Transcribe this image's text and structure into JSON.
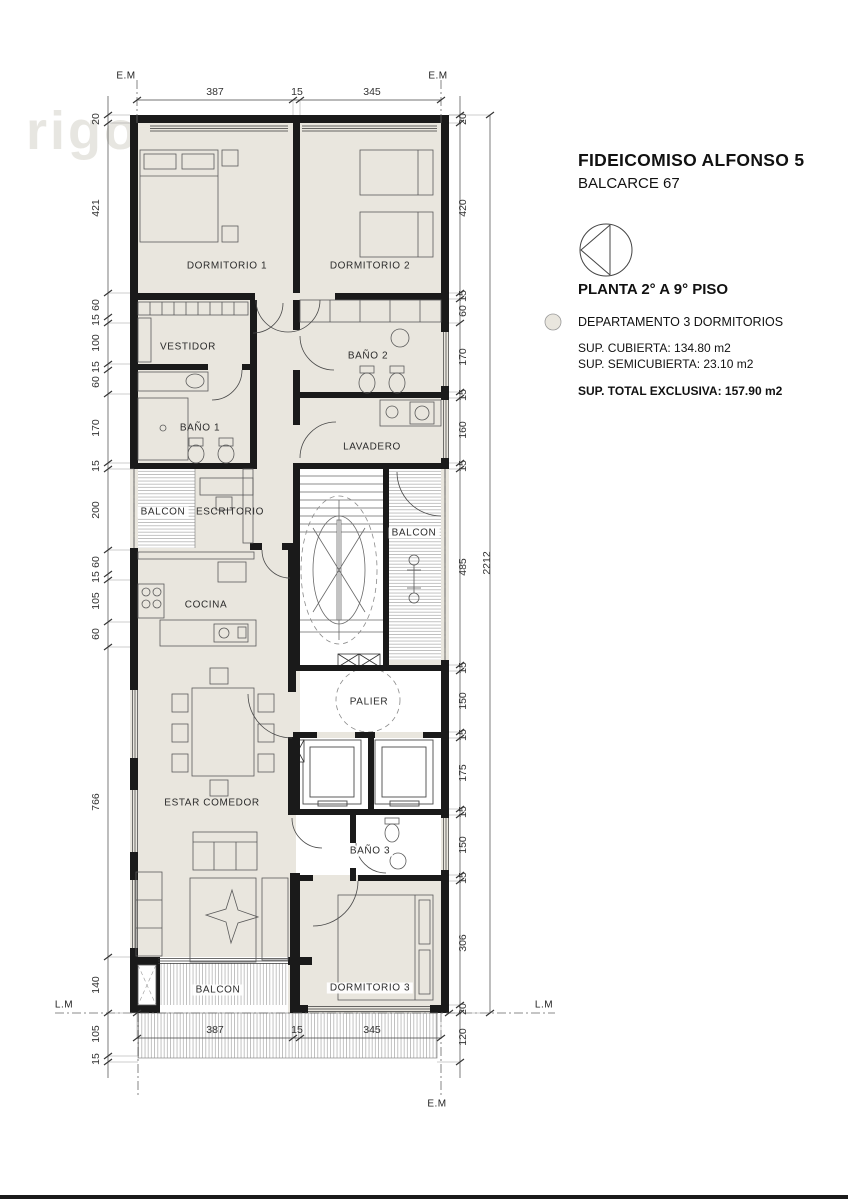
{
  "title_block": {
    "title": "FIDEICOMISO ALFONSO 5",
    "subtitle": "BALCARCE 67",
    "plan_label": "PLANTA 2° A 9° PISO",
    "unit_label": "DEPARTAMENTO 3 DORMITORIOS",
    "sup_cubierta": "SUP. CUBIERTA: 134.80 m2",
    "sup_semicubierta": "SUP. SEMICUBIERTA:  23.10 m2",
    "sup_total": "SUP. TOTAL EXCLUSIVA: 157.90 m2"
  },
  "watermark": "rigo.",
  "markers": {
    "em": "E.M",
    "lm": "L.M"
  },
  "rooms": {
    "dormitorio1": "DORMITORIO 1",
    "dormitorio2": "DORMITORIO 2",
    "vestidor": "VESTIDOR",
    "bano1": "BAÑO 1",
    "bano2": "BAÑO 2",
    "lavadero": "LAVADERO",
    "balcon_left": "BALCON",
    "escritorio": "ESCRITORIO",
    "cocina": "COCINA",
    "balcon_right": "BALCON",
    "palier": "PALIER",
    "estar_comedor": "ESTAR COMEDOR",
    "bano3": "BAÑO  3",
    "dormitorio3": "DORMITORIO 3",
    "balcon_bottom": "BALCON"
  },
  "dims": {
    "top": [
      "387",
      "15",
      "345"
    ],
    "bottom": [
      "387",
      "15",
      "345"
    ],
    "left": [
      "20",
      "421",
      "60",
      "15",
      "100",
      "15",
      "60",
      "170",
      "15",
      "200",
      "60",
      "15",
      "105",
      "60",
      "766",
      "140"
    ],
    "left_bottom": [
      "105",
      "15"
    ],
    "right": [
      "20",
      "420",
      "15",
      "60",
      "170",
      "15",
      "160",
      "15",
      "485",
      "15",
      "150",
      "15",
      "175",
      "15",
      "150",
      "15",
      "306",
      "20"
    ],
    "right_bottom": [
      "120"
    ],
    "total": "2212"
  }
}
